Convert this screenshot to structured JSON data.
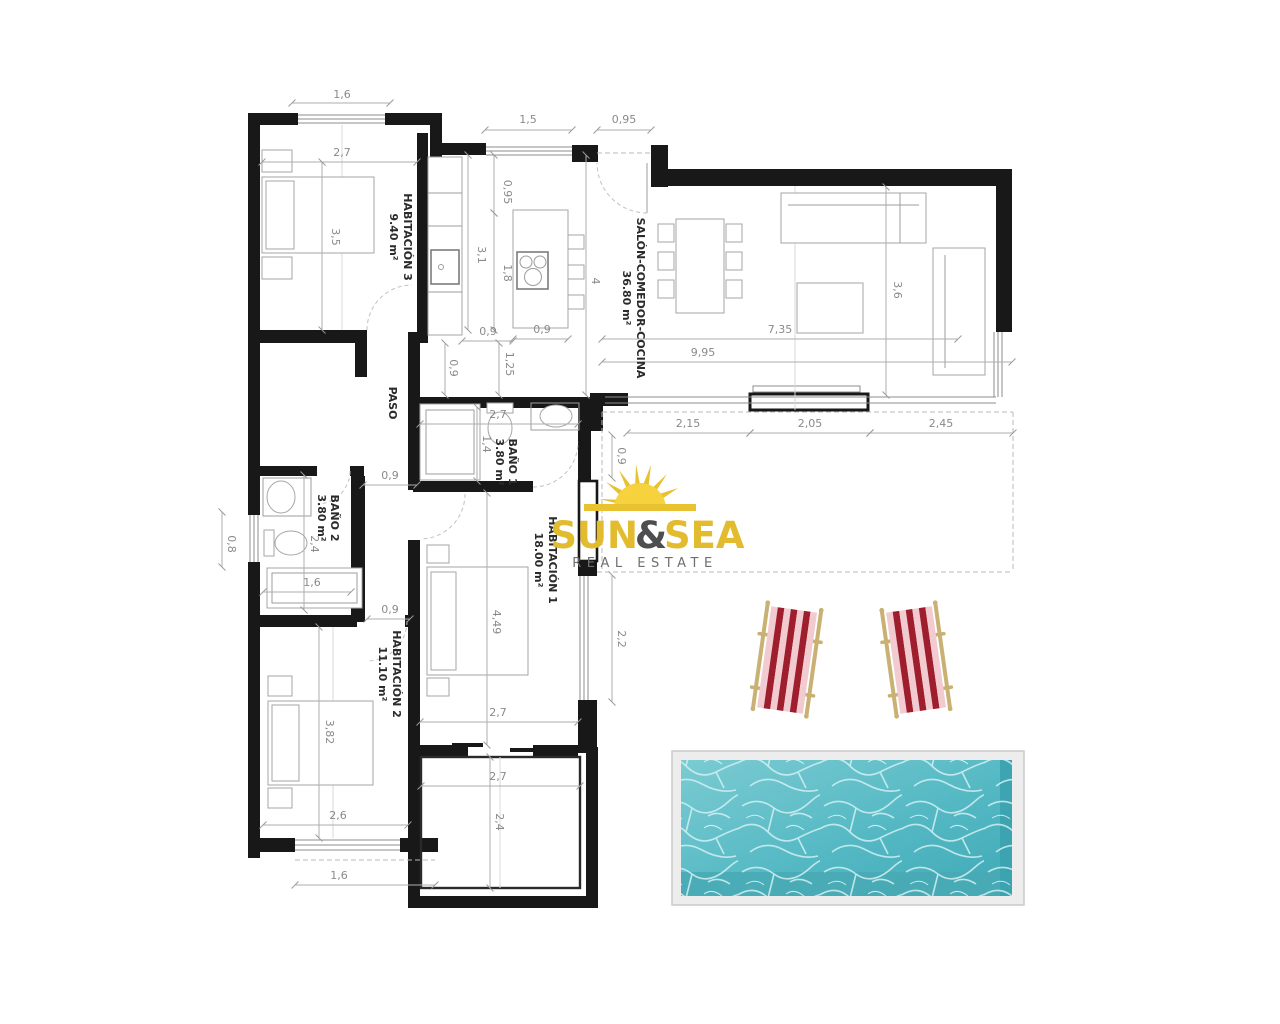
{
  "branding": {
    "word1": "SUN",
    "ampersand": "&",
    "word2": "SEA",
    "tagline": "REAL ESTATE"
  },
  "rooms": [
    {
      "name": "HABITACIÓN 3",
      "area": "9.40 m²"
    },
    {
      "name": "SALÓN-COMEDOR-COCINA",
      "area": "36.80 m²"
    },
    {
      "name": "PASO",
      "area": ""
    },
    {
      "name": "BAÑO 1",
      "area": "3.80 m²"
    },
    {
      "name": "BAÑO 2",
      "area": "3.80 m²"
    },
    {
      "name": "HABITACIÓN 1",
      "area": "18.00 m²"
    },
    {
      "name": "HABITACIÓN 2",
      "area": "11.10 m²"
    }
  ],
  "dims": {
    "h": [
      "1,6",
      "2,7",
      "1,5",
      "0,95",
      "0,9",
      "0,9",
      "7,35",
      "9,95",
      "2,15",
      "2,05",
      "2,45",
      "2,7",
      "0,9",
      "1,6",
      "0,9",
      "2,7",
      "2,7",
      "2,6",
      "1,6"
    ],
    "v": [
      "3,5",
      "0,95",
      "3,1",
      "1,8",
      "4",
      "1,25",
      "0,9",
      "3,6",
      "1,4",
      "2,4",
      "0,8",
      "4,49",
      "2,2",
      "0,9",
      "2,4",
      "3,82"
    ]
  },
  "colors": {
    "wall": "#181818",
    "logo_gold": "#E2BC2E",
    "logo_dark": "#4E4E50",
    "pool_water": "#55b9c4",
    "chair_red": "#9e1e2e",
    "chair_pink": "#f2cbd0"
  }
}
